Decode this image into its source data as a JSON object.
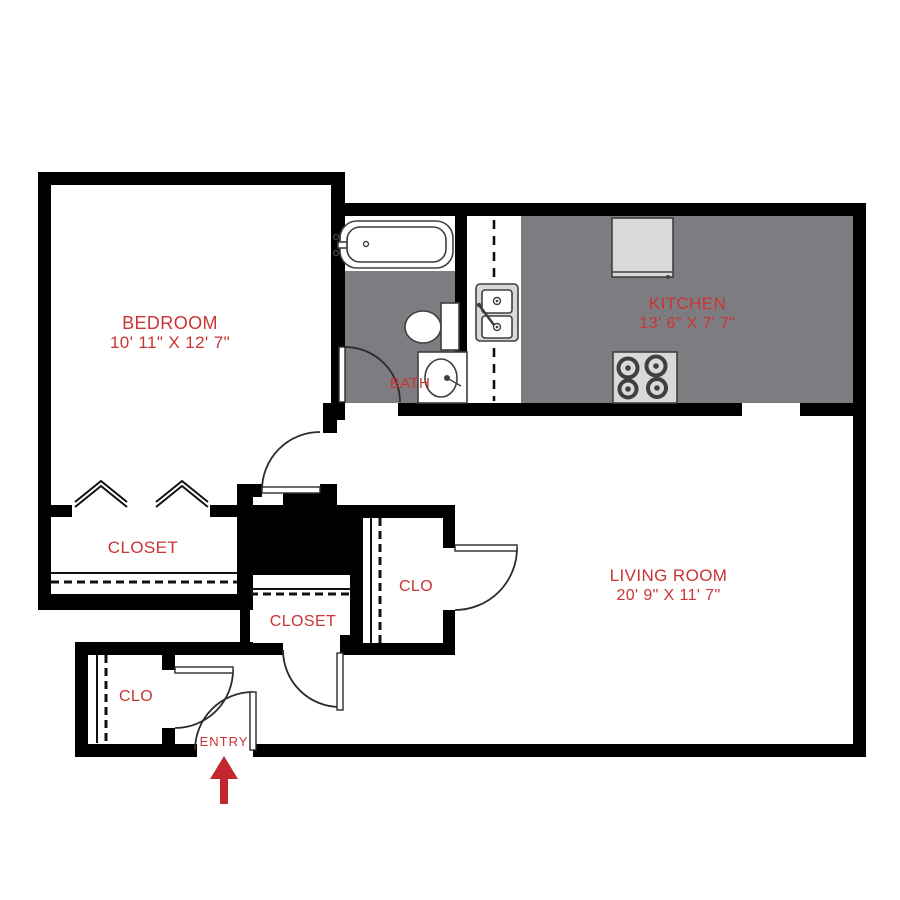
{
  "rooms": {
    "bedroom": {
      "label": "BEDROOM",
      "dimensions": "10' 11\" X 12' 7\""
    },
    "kitchen": {
      "label": "KITCHEN",
      "dimensions": "13' 6\" X 7' 7\""
    },
    "living_room": {
      "label": "LIVING ROOM",
      "dimensions": "20' 9\" X 11' 7\""
    },
    "bath": {
      "label": "BATH"
    },
    "bedroom_closet": {
      "label": "CLOSET"
    },
    "hall_closet": {
      "label": "CLOSET"
    },
    "hall_clo": {
      "label": "CLO"
    },
    "entry_clo": {
      "label": "CLO"
    },
    "entry": {
      "label": "ENTRY"
    }
  },
  "colors": {
    "wall_black": "#000000",
    "floor_gray": "#7d7d81",
    "label_red": "#cc3333",
    "arrow_red": "#c1272d",
    "fixture_fill": "#d9d9d9",
    "fixture_line": "#3f3f3f"
  }
}
